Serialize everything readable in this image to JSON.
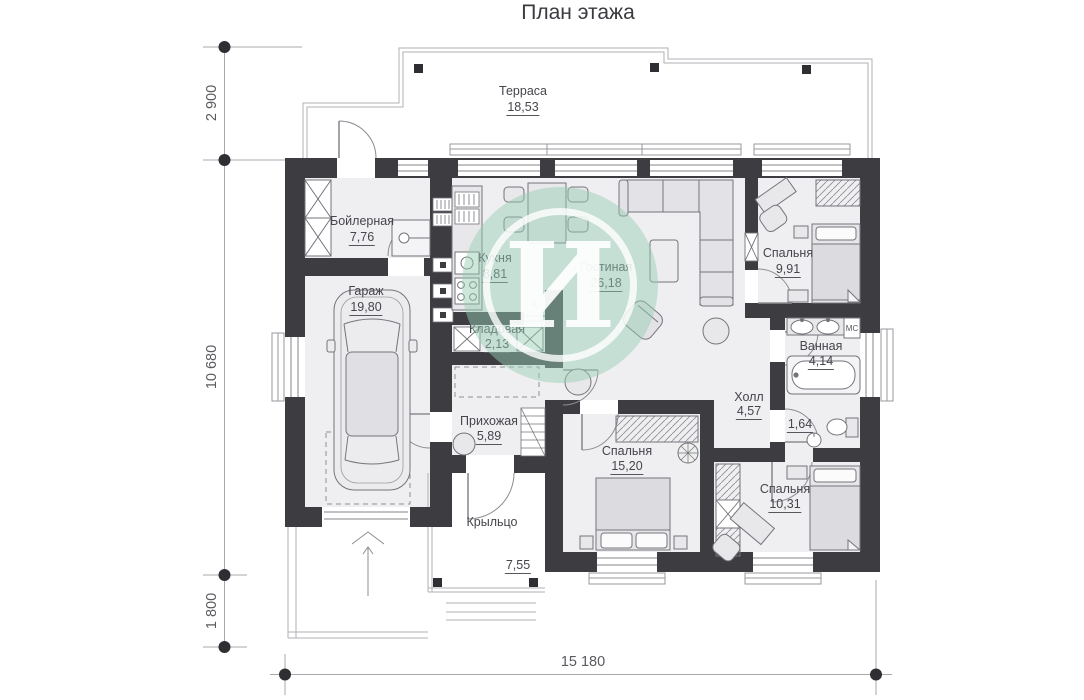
{
  "title": "План этажа",
  "watermark": {
    "letter": "И"
  },
  "rooms": {
    "terrace": {
      "name": "Терраса",
      "area": "18,53"
    },
    "boiler": {
      "name": "Бойлерная",
      "area": "7,76"
    },
    "garage": {
      "name": "Гараж",
      "area": "19,80"
    },
    "kitchen": {
      "name": "Кухня",
      "area": "8,81"
    },
    "pantry": {
      "name": "Кладовая",
      "area": "2,13"
    },
    "living": {
      "name": "Гостиная",
      "area": "26,18"
    },
    "bedroom1": {
      "name": "Спальня",
      "area": "9,91"
    },
    "bathroom": {
      "name": "Ванная",
      "area": "4,14"
    },
    "hall": {
      "name": "Холл",
      "area": "4,57"
    },
    "wc": {
      "area": "1,64"
    },
    "entry": {
      "name": "Прихожая",
      "area": "5,89"
    },
    "bedroom2": {
      "name": "Спальня",
      "area": "15,20"
    },
    "bedroom3": {
      "name": "Спальня",
      "area": "10,31"
    },
    "porch": {
      "name": "Крыльцо",
      "area": "7,55"
    }
  },
  "dimensions": {
    "left_top": "2 900",
    "left_middle": "10 680",
    "left_bottom": "1 800",
    "bottom": "15 180"
  },
  "labels": {
    "washer": "МС",
    "door_mark": "x"
  },
  "colors": {
    "wall": "#3c3c41",
    "floor": "#efeff1",
    "furniture_stroke": "#74747a",
    "hatch": "#8f8f94",
    "thin_outline": "#b2b2b6",
    "dimension": "#5a5a60",
    "watermark_green": "#96cdb4",
    "text": "#45454b"
  }
}
